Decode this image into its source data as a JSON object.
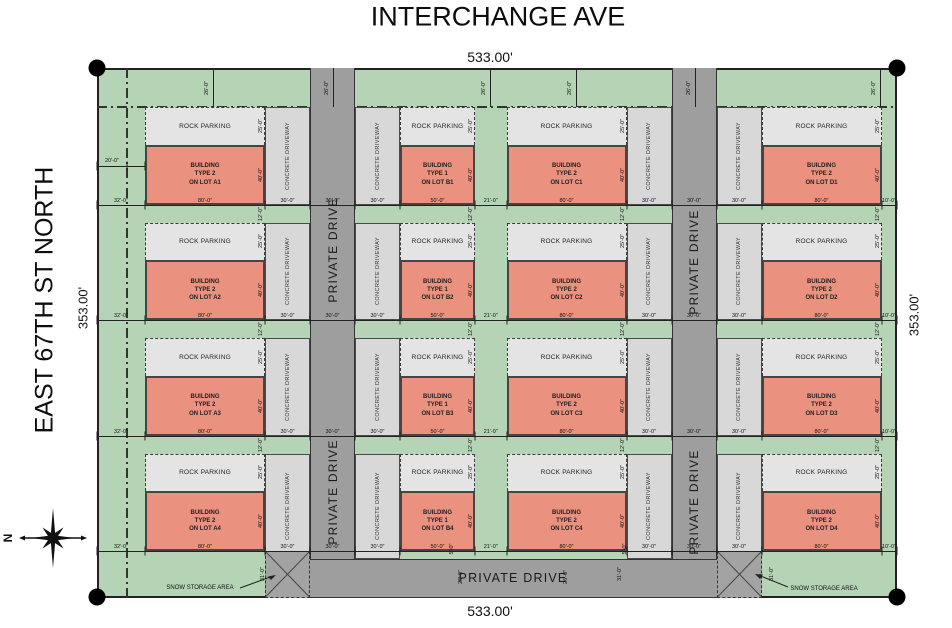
{
  "streets": {
    "top": "INTERCHANGE AVE",
    "left": "EAST 67TH ST NORTH"
  },
  "boundary_dims": {
    "top": "533.00'",
    "bottom": "533.00'",
    "left": "353.00'",
    "right": "353.00'"
  },
  "labels": {
    "rock_parking": "ROCK PARKING",
    "concrete_driveway": "CONCRETE DRIVEWAY",
    "private_drive": "PRIVATE DRIVE",
    "snow_storage_area": "SNOW STORAGE AREA",
    "north": "N"
  },
  "lots": [
    {
      "id": "A1",
      "label": "BUILDING\nTYPE 2\nON LOT A1"
    },
    {
      "id": "A2",
      "label": "BUILDING\nTYPE 2\nON LOT A2"
    },
    {
      "id": "A3",
      "label": "BUILDING\nTYPE 2\nON LOT A3"
    },
    {
      "id": "A4",
      "label": "BUILDING\nTYPE 2\nON LOT A4"
    },
    {
      "id": "B1",
      "label": "BUILDING\nTYPE 1\nON LOT B1"
    },
    {
      "id": "B2",
      "label": "BUILDING\nTYPE 1\nON LOT B2"
    },
    {
      "id": "B3",
      "label": "BUILDING\nTYPE 1\nON LOT B3"
    },
    {
      "id": "B4",
      "label": "BUILDING\nTYPE 1\nON LOT B4"
    },
    {
      "id": "C1",
      "label": "BUILDING\nTYPE 2\nON LOT C1"
    },
    {
      "id": "C2",
      "label": "BUILDING\nTYPE 2\nON LOT C2"
    },
    {
      "id": "C3",
      "label": "BUILDING\nTYPE 2\nON LOT C3"
    },
    {
      "id": "C4",
      "label": "BUILDING\nTYPE 2\nON LOT C4"
    },
    {
      "id": "D1",
      "label": "BUILDING\nTYPE 2\nON LOT D1"
    },
    {
      "id": "D2",
      "label": "BUILDING\nTYPE 2\nON LOT D2"
    },
    {
      "id": "D3",
      "label": "BUILDING\nTYPE 2\nON LOT D3"
    },
    {
      "id": "D4",
      "label": "BUILDING\nTYPE 2\nON LOT D4"
    }
  ],
  "row_dim_labels": [
    "32'-0\"",
    "80'-0\"",
    "30'-0\"",
    "30'-0\"",
    "30'-0\"",
    "50'-0\"",
    "21'-0\"",
    "80'-0\"",
    "30'-0\"",
    "30'-0\"",
    "30'-0\"",
    "80'-0\"",
    "10'-0\""
  ],
  "lot_dims": {
    "parking_depth": "25'-0\"",
    "building_depth": "40'-0\"",
    "row_gap": "12'-0\"",
    "top_strip": "26'-0\"",
    "left_setback": "20'-0\"",
    "snow_depth": "31'-0\"",
    "road_width": "26'-0\"",
    "building_offset": "5'-0\""
  },
  "colors": {
    "site_green": "#b5d4b5",
    "parking": "#e4e4e4",
    "driveway": "#d8d8d8",
    "road": "#9e9e9e",
    "building": "#ea9180",
    "snow": "#a3a3a3",
    "line": "#222222"
  }
}
